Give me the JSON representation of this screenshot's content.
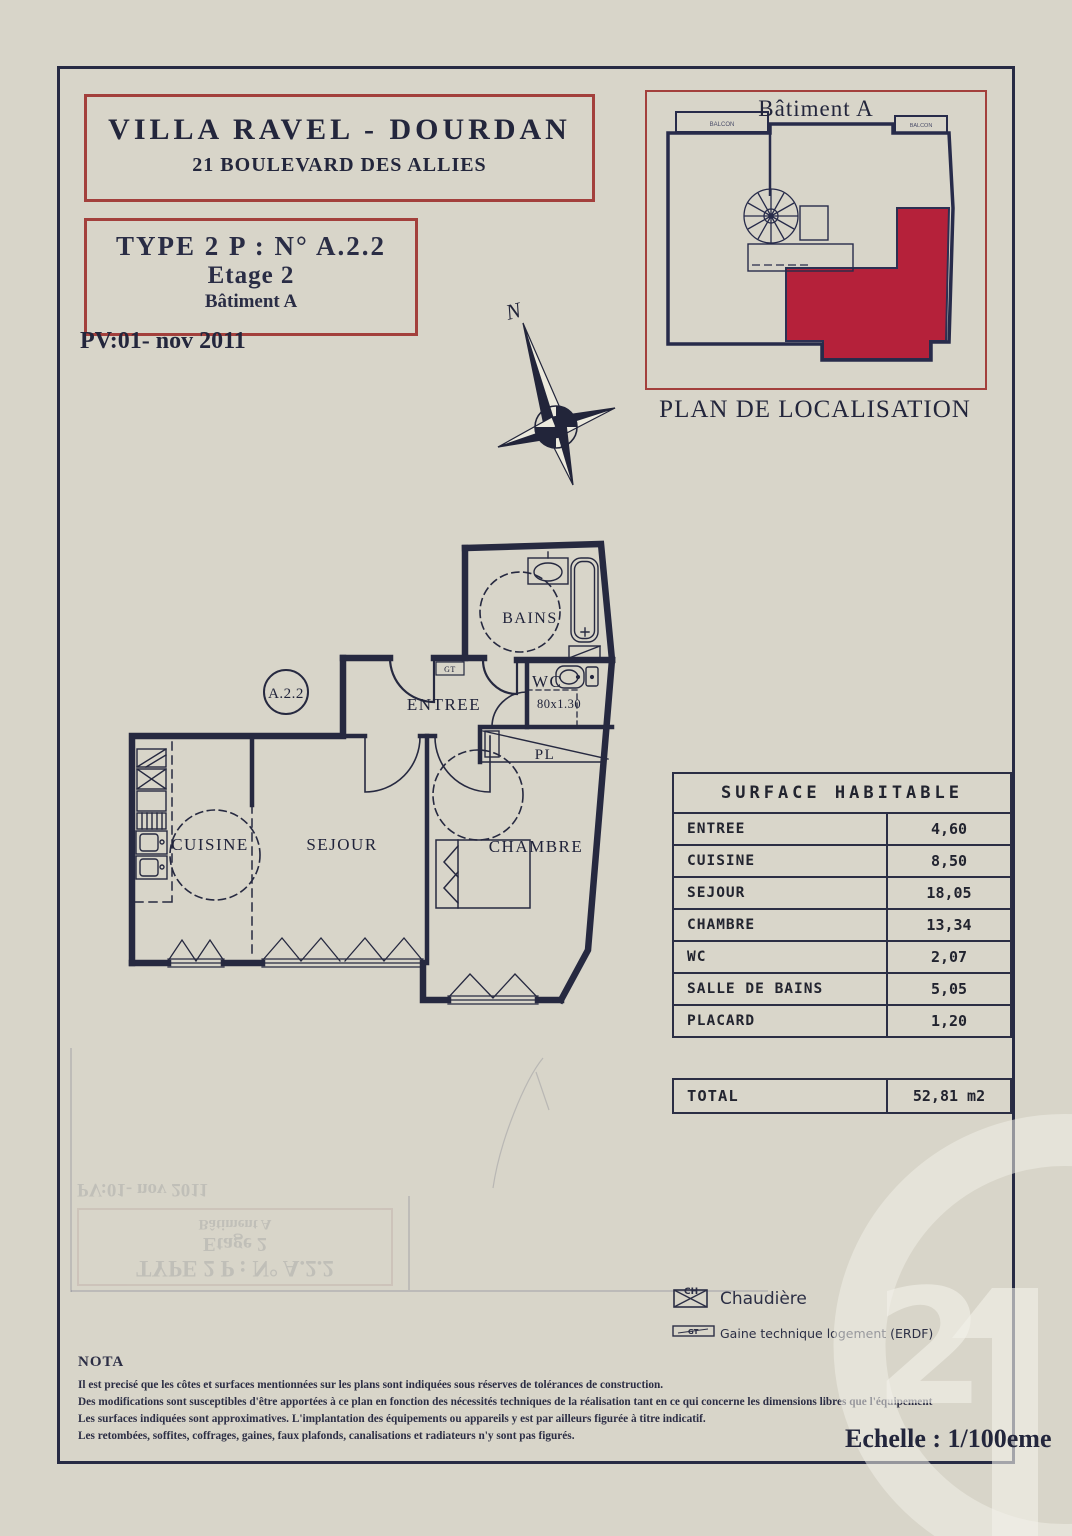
{
  "colors": {
    "ink": "#262940",
    "red_border": "#a3403c",
    "red_fill": "#b5213a",
    "paper_light": "#edeadd",
    "paper_dark": "#b3b0a7",
    "watermark": "#f0eee6"
  },
  "header": {
    "project_title": "VILLA RAVEL - DOURDAN",
    "project_address": "21 BOULEVARD DES ALLIES"
  },
  "unit_box": {
    "type": "TYPE 2 P : N° A.2.2",
    "floor": "Etage 2",
    "building": "Bâtiment A"
  },
  "pv_date": "PV:01- nov 2011",
  "compass": {
    "north": "N"
  },
  "localisation": {
    "title": "Bâtiment A",
    "caption": "PLAN DE LOCALISATION",
    "balcony_left": "BALCON",
    "balcony_right": "BALCON"
  },
  "plan": {
    "unit": "A.2.2",
    "entree": "ENTREE",
    "bains": "BAINS",
    "wc": "WC",
    "wc_dim": "80x1.30",
    "pl": "PL",
    "cuisine": "CUISINE",
    "sejour": "SEJOUR",
    "chambre": "CHAMBRE",
    "gt": "GT"
  },
  "surface_table": {
    "title": "SURFACE HABITABLE",
    "rows": [
      {
        "label": "ENTREE",
        "value": "4,60"
      },
      {
        "label": "CUISINE",
        "value": "8,50"
      },
      {
        "label": "SEJOUR",
        "value": "18,05"
      },
      {
        "label": "CHAMBRE",
        "value": "13,34"
      },
      {
        "label": "WC",
        "value": "2,07"
      },
      {
        "label": "SALLE DE BAINS",
        "value": "5,05"
      },
      {
        "label": "PLACARD",
        "value": "1,20"
      }
    ],
    "total": {
      "label": "TOTAL",
      "value": "52,81 m2"
    }
  },
  "legend": {
    "chaudiere": {
      "symbol": "CH",
      "label": "Chaudière"
    },
    "gaine": {
      "symbol": "GT",
      "label": "Gaine technique logement (ERDF)"
    }
  },
  "nota": {
    "title": "NOTA",
    "lines": [
      "Il est precisé que les côtes et surfaces mentionnées sur les plans sont indiquées sous réserves de tolérances de construction.",
      "Des modifications sont susceptibles d'être apportées à ce plan en fonction  des nécessités techniques de la réalisation tant en ce qui concerne les  dimensions libres que l'équipement",
      "Les surfaces indiquées sont approximatives. L'implantation des équipements ou appareils y est par ailleurs figurée à titre indicatif.",
      "Les retombées, soffites, coffrages, gaines, faux plafonds, canalisations et radiateurs n'y sont pas figurés."
    ]
  },
  "scale_note": "Echelle : 1/100eme",
  "watermark": {
    "number_2": "2"
  },
  "bleedthrough": {
    "type": "TYPE 2 P : N° A.2.2",
    "floor": "Etage 2",
    "building": "Bâtiment A",
    "pv": "PV:01- nov 2011"
  }
}
